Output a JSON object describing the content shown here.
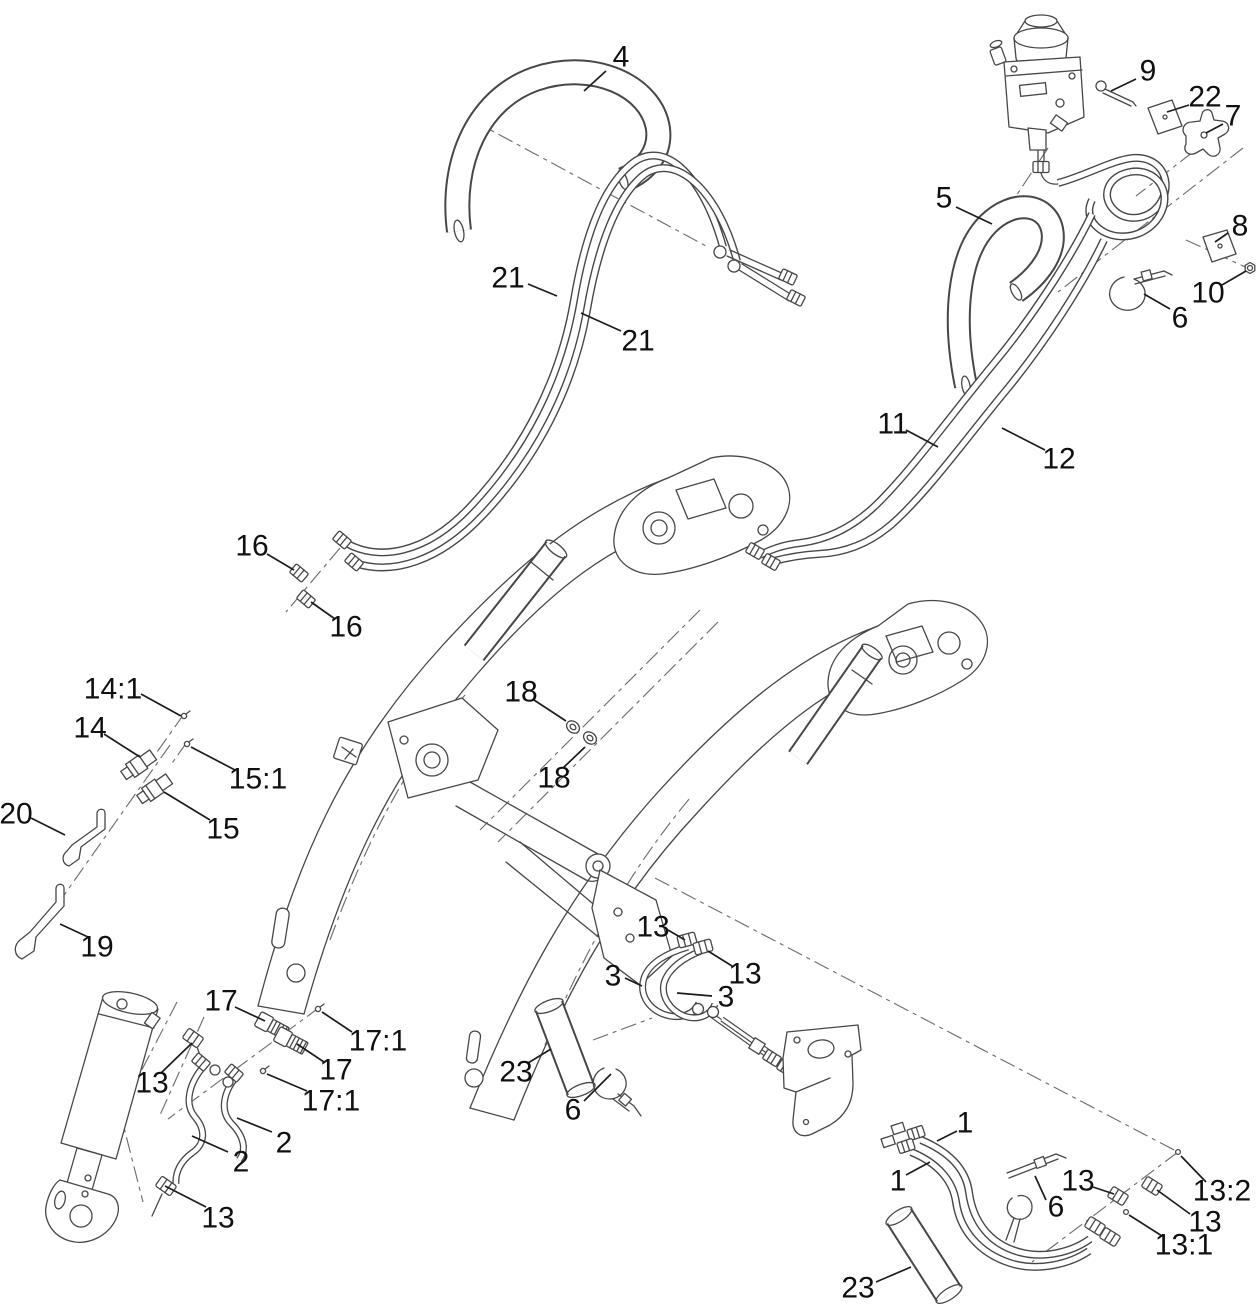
{
  "diagram": {
    "kind": "exploded-parts-diagram",
    "background": "#ffffff",
    "line_color": "#474747",
    "dash_color": "#6f6f6f",
    "label_color": "#101010",
    "label_font_size": 30,
    "part_numbers_visible": [
      "1",
      "2",
      "3",
      "4",
      "5",
      "6",
      "7",
      "8",
      "9",
      "10",
      "11",
      "12",
      "13",
      "13:1",
      "13:2",
      "14",
      "14:1",
      "15",
      "15:1",
      "16",
      "17",
      "17:1",
      "18",
      "19",
      "20",
      "21",
      "22",
      "23"
    ]
  },
  "callouts": [
    {
      "text": "4",
      "x": 621,
      "y": 57,
      "leader": [
        606,
        71,
        584,
        91
      ]
    },
    {
      "text": "9",
      "x": 1148,
      "y": 71,
      "leader": [
        1136,
        79,
        1111,
        91
      ]
    },
    {
      "text": "22",
      "x": 1205,
      "y": 97,
      "leader": [
        1189,
        105,
        1167,
        112
      ]
    },
    {
      "text": "7",
      "x": 1233,
      "y": 116,
      "leader": [
        1223,
        124,
        1206,
        133
      ]
    },
    {
      "text": "5",
      "x": 944,
      "y": 198,
      "leader": [
        956,
        207,
        992,
        224
      ]
    },
    {
      "text": "8",
      "x": 1240,
      "y": 226,
      "leader": [
        1228,
        233,
        1215,
        242
      ]
    },
    {
      "text": "10",
      "x": 1208,
      "y": 293,
      "leader": [
        1222,
        285,
        1246,
        271
      ]
    },
    {
      "text": "6",
      "x": 1180,
      "y": 318,
      "leader": [
        1170,
        309,
        1144,
        294
      ]
    },
    {
      "text": "21",
      "x": 508,
      "y": 278,
      "leader": [
        528,
        284,
        557,
        296
      ]
    },
    {
      "text": "21",
      "x": 638,
      "y": 341,
      "leader": [
        621,
        331,
        581,
        313
      ]
    },
    {
      "text": "11",
      "x": 893,
      "y": 424,
      "leader": [
        906,
        430,
        938,
        447
      ]
    },
    {
      "text": "12",
      "x": 1059,
      "y": 459,
      "leader": [
        1045,
        450,
        1002,
        428
      ]
    },
    {
      "text": "16",
      "x": 252,
      "y": 546,
      "leader": [
        267,
        554,
        294,
        570
      ]
    },
    {
      "text": "16",
      "x": 346,
      "y": 627,
      "leader": [
        335,
        619,
        311,
        602
      ]
    },
    {
      "text": "18",
      "x": 521,
      "y": 692,
      "leader": [
        534,
        700,
        566,
        721
      ]
    },
    {
      "text": "18",
      "x": 554,
      "y": 778,
      "leader": [
        563,
        768,
        585,
        747
      ]
    },
    {
      "text": "14:1",
      "x": 113,
      "y": 689,
      "leader": [
        141,
        694,
        181,
        716
      ]
    },
    {
      "text": "14",
      "x": 90,
      "y": 728,
      "leader": [
        104,
        734,
        140,
        757
      ]
    },
    {
      "text": "15:1",
      "x": 258,
      "y": 779,
      "leader": [
        235,
        770,
        191,
        747
      ]
    },
    {
      "text": "15",
      "x": 223,
      "y": 829,
      "leader": [
        210,
        820,
        164,
        792
      ]
    },
    {
      "text": "20",
      "x": 16,
      "y": 814,
      "leader": [
        31,
        818,
        65,
        835
      ]
    },
    {
      "text": "19",
      "x": 97,
      "y": 947,
      "leader": [
        88,
        937,
        60,
        924
      ]
    },
    {
      "text": "13",
      "x": 653,
      "y": 927,
      "leader": [
        668,
        930,
        685,
        940
      ]
    },
    {
      "text": "13",
      "x": 745,
      "y": 974,
      "leader": [
        732,
        966,
        708,
        951
      ]
    },
    {
      "text": "3",
      "x": 613,
      "y": 976,
      "leader": [
        625,
        978,
        642,
        986
      ]
    },
    {
      "text": "3",
      "x": 726,
      "y": 997,
      "leader": [
        712,
        996,
        677,
        993
      ]
    },
    {
      "text": "17",
      "x": 221,
      "y": 1001,
      "leader": [
        235,
        1007,
        265,
        1021
      ]
    },
    {
      "text": "17:1",
      "x": 378,
      "y": 1041,
      "leader": [
        352,
        1032,
        322,
        1012
      ]
    },
    {
      "text": "17",
      "x": 336,
      "y": 1070,
      "leader": [
        324,
        1062,
        297,
        1044
      ]
    },
    {
      "text": "13",
      "x": 152,
      "y": 1083,
      "leader": [
        161,
        1073,
        192,
        1043
      ]
    },
    {
      "text": "17:1",
      "x": 331,
      "y": 1101,
      "leader": [
        307,
        1091,
        267,
        1074
      ]
    },
    {
      "text": "23",
      "x": 516,
      "y": 1072,
      "leader": [
        528,
        1063,
        551,
        1049
      ]
    },
    {
      "text": "2",
      "x": 284,
      "y": 1143,
      "leader": [
        272,
        1132,
        237,
        1118
      ]
    },
    {
      "text": "6",
      "x": 573,
      "y": 1110,
      "leader": [
        584,
        1101,
        611,
        1074
      ]
    },
    {
      "text": "2",
      "x": 241,
      "y": 1162,
      "leader": [
        228,
        1152,
        192,
        1136
      ]
    },
    {
      "text": "13",
      "x": 218,
      "y": 1218,
      "leader": [
        206,
        1207,
        165,
        1186
      ]
    },
    {
      "text": "1",
      "x": 965,
      "y": 1123,
      "leader": [
        957,
        1131,
        937,
        1141
      ]
    },
    {
      "text": "1",
      "x": 898,
      "y": 1181,
      "leader": [
        906,
        1175,
        930,
        1162
      ]
    },
    {
      "text": "13",
      "x": 1078,
      "y": 1181,
      "leader": [
        1093,
        1187,
        1114,
        1194
      ]
    },
    {
      "text": "6",
      "x": 1056,
      "y": 1207,
      "leader": [
        1046,
        1200,
        1035,
        1176
      ]
    },
    {
      "text": "13:2",
      "x": 1222,
      "y": 1191,
      "leader": [
        1206,
        1182,
        1181,
        1156
      ]
    },
    {
      "text": "13",
      "x": 1205,
      "y": 1222,
      "leader": [
        1190,
        1214,
        1157,
        1190
      ]
    },
    {
      "text": "13:1",
      "x": 1184,
      "y": 1245,
      "leader": [
        1162,
        1236,
        1129,
        1215
      ]
    },
    {
      "text": "23",
      "x": 858,
      "y": 1288,
      "leader": [
        876,
        1282,
        911,
        1267
      ]
    }
  ]
}
